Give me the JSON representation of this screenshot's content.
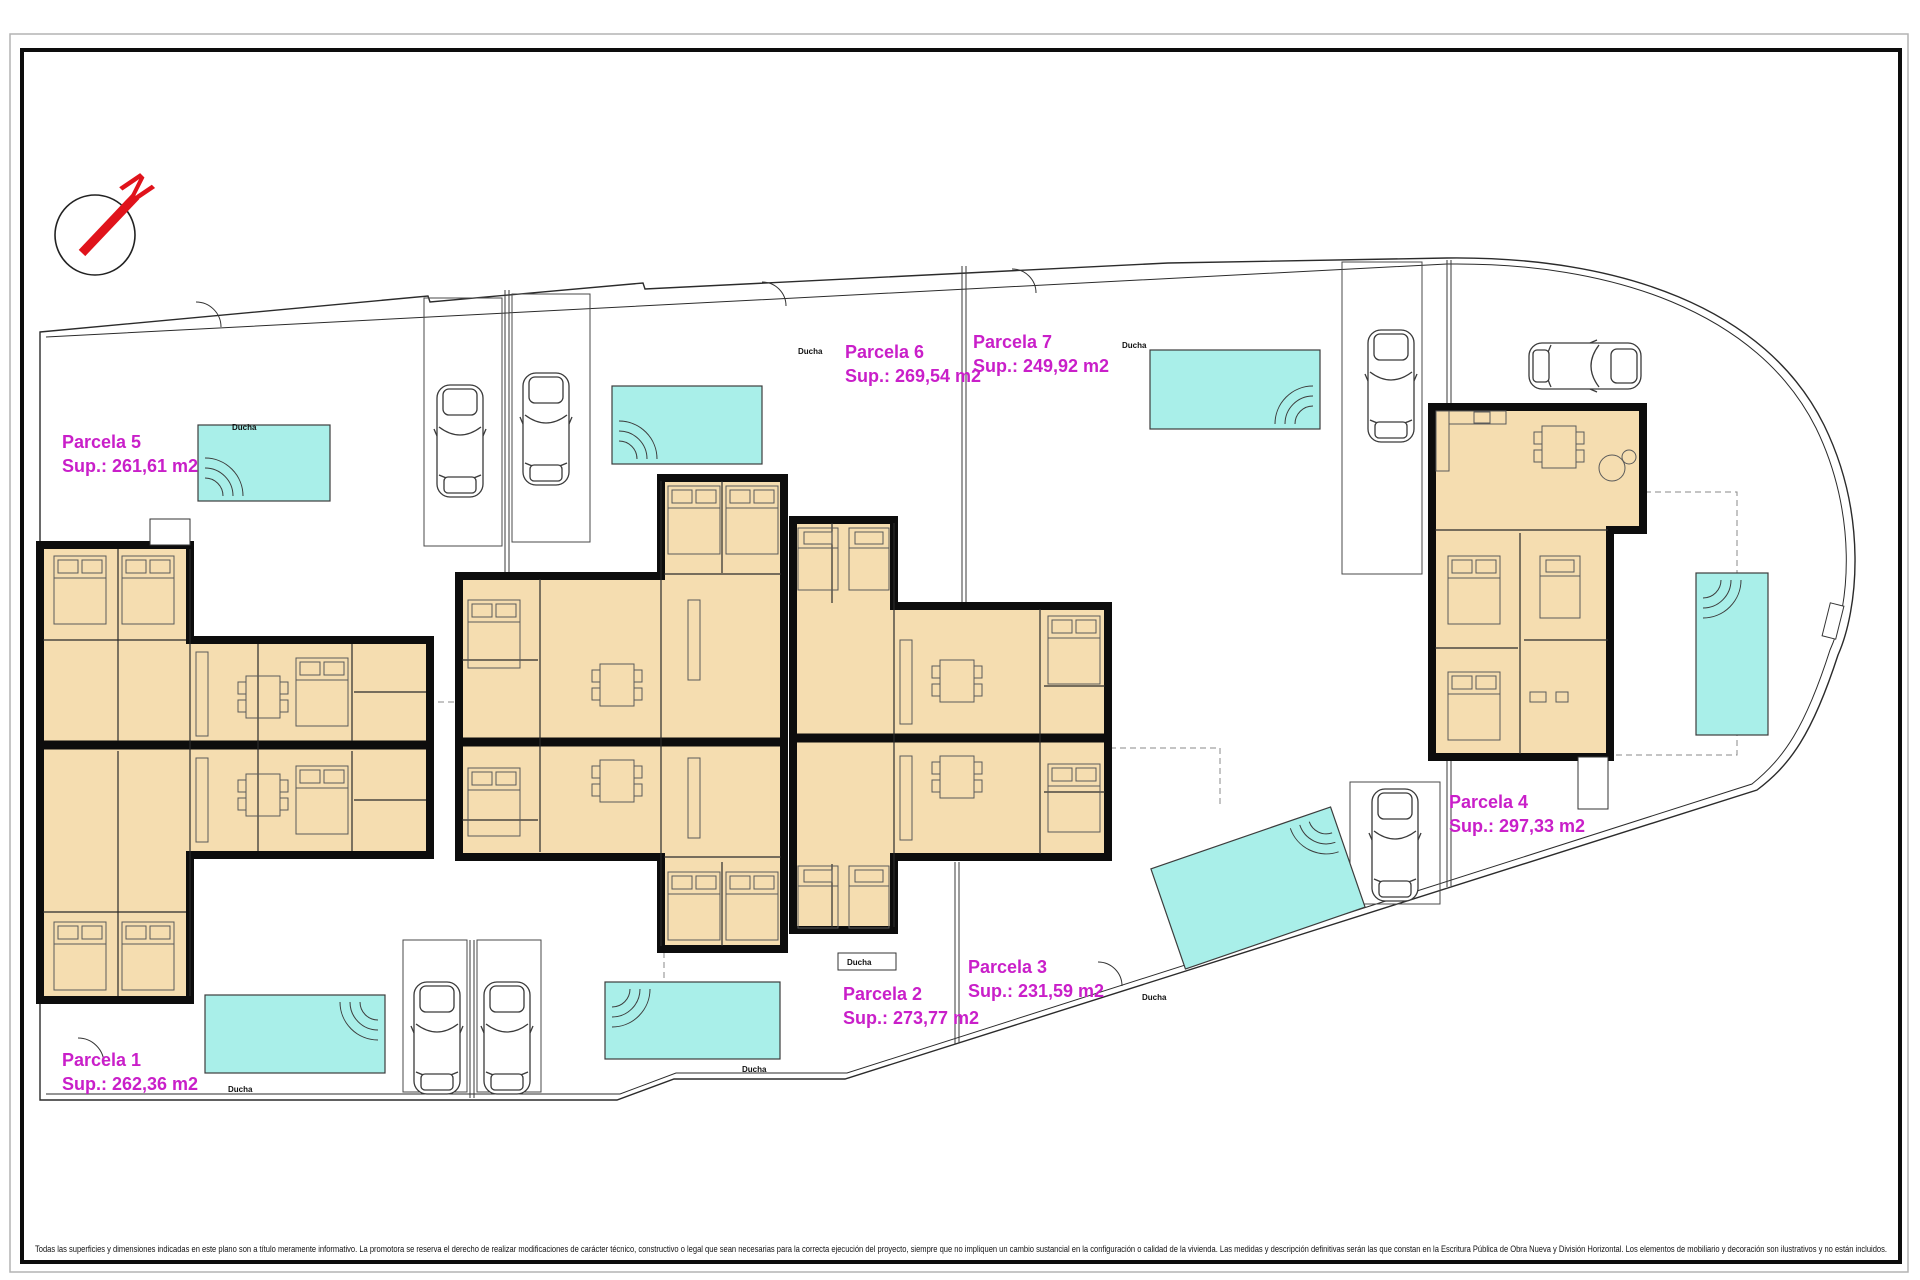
{
  "page": {
    "disclaimer": "Todas las superficies y dimensiones indicadas en este plano son a título meramente informativo. La promotora se reserva el derecho de realizar modificaciones de carácter técnico, constructivo o legal que sean necesarias para la correcta ejecución del proyecto, siempre que no impliquen un cambio sustancial en la configuración o calidad de la vivienda. Las medidas y descripción definitivas serán las que constan en la Escritura Pública de Obra Nueva y División Horizontal. Los elementos de mobiliario y decoración son ilustrativos y no están incluidos.",
    "compass_letter": "N",
    "shower_label": "Ducha"
  },
  "colors": {
    "parcel_label": "#c91fc9",
    "pool_fill": "#a9efe9",
    "room_fill": "#f5ddb0",
    "wall": "#0d0d0d",
    "north_red": "#e0131b"
  },
  "parcels": [
    {
      "name": "Parcela 1",
      "area": "Sup.: 262,36 m2"
    },
    {
      "name": "Parcela 2",
      "area": "Sup.: 273,77 m2"
    },
    {
      "name": "Parcela 3",
      "area": "Sup.: 231,59 m2"
    },
    {
      "name": "Parcela 4",
      "area": "Sup.: 297,33 m2"
    },
    {
      "name": "Parcela 5",
      "area": "Sup.: 261,61 m2"
    },
    {
      "name": "Parcela 6",
      "area": "Sup.: 269,54 m2"
    },
    {
      "name": "Parcela 7",
      "area": "Sup.: 249,92 m2"
    }
  ]
}
